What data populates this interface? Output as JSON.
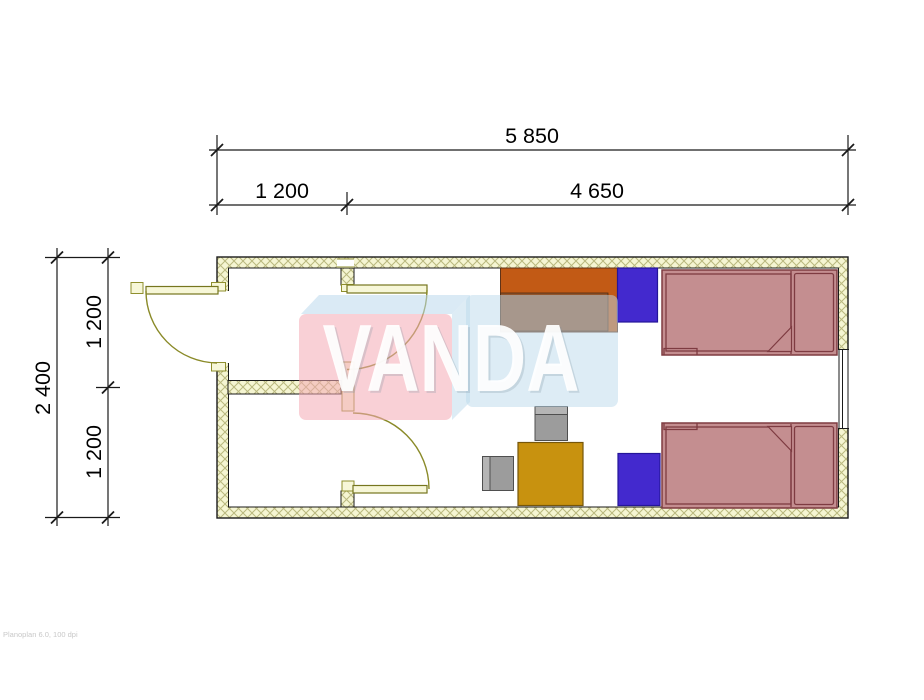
{
  "dimensions": {
    "top_total": "5 850",
    "top_seg1": "1 200",
    "top_seg2": "4 650",
    "side_total": "2 400",
    "side_seg1": "1 200",
    "side_seg2": "1 200"
  },
  "watermark": {
    "text": "VANDA"
  },
  "footer": {
    "text": "Planoplan 6.0, 100 dpi"
  },
  "colors": {
    "wall_fill": "#f5f5d2",
    "wall_hatch": "#b9b87e",
    "floor": "#ffffff",
    "wardrobe": "#c25a15",
    "wardrobe_inner": "#92552c",
    "cabinet": "#4329ce",
    "bed": "#c48e90",
    "bed_outline": "#7e3b41",
    "table": "#c8920f",
    "chair": "#9c9c9c",
    "chair_back": "#b5b5b5",
    "door": "#f7f7d8",
    "watermark_pink": "#f4aab4",
    "watermark_blue": "#bcd9ec",
    "dimension": "#1a1a1a"
  }
}
